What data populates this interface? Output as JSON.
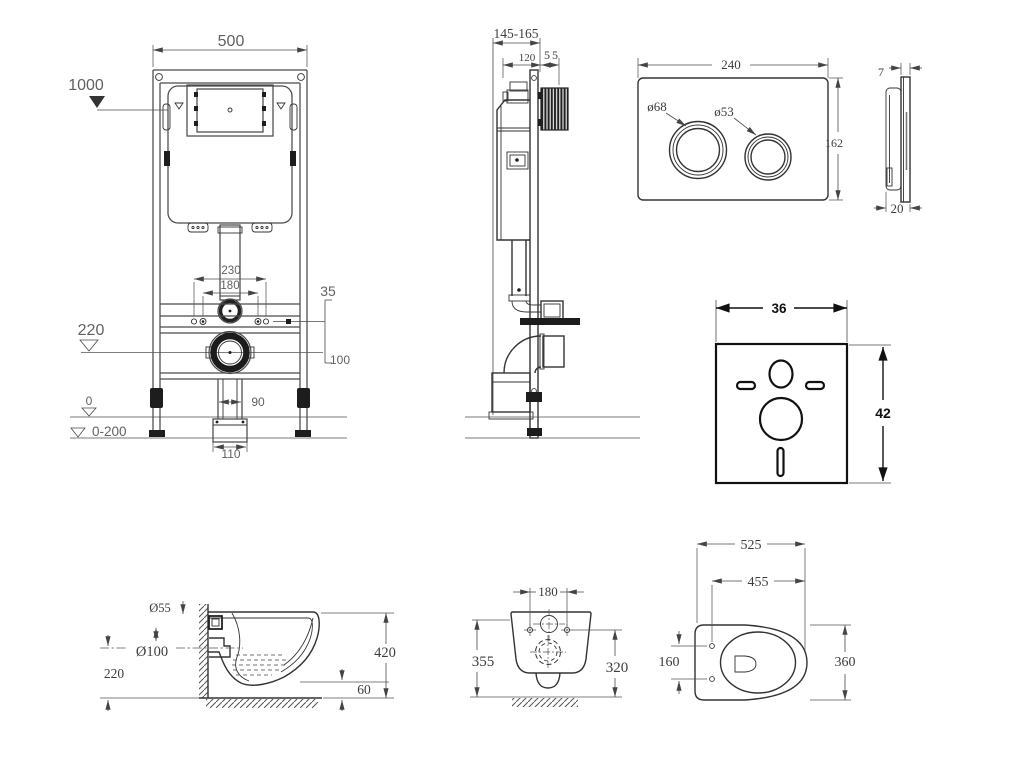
{
  "document": {
    "type": "technical installation drawing",
    "subject": "wall-hung WC frame, flush plate, sound pad and pan",
    "background_color": "#ffffff",
    "line_color": "#3d3d3d",
    "text_color": "#555555"
  },
  "views": {
    "frame_front": {
      "name": "installation frame front view",
      "dims": {
        "width": "500",
        "flush_height": "1000",
        "span_outer": "230",
        "span_inner": "180",
        "offset_a": "35",
        "offset_b": "100",
        "drain_height": "220",
        "foot_width": "90",
        "plate_width": "110",
        "level_zero": "0",
        "level_range": "0-200"
      }
    },
    "frame_side": {
      "name": "installation frame side view",
      "dims": {
        "depth_range": "145-165",
        "depth_frame": "120",
        "depth_plate": "55"
      }
    },
    "plate_front": {
      "name": "flush plate front view",
      "dims": {
        "width": "240",
        "height": "162",
        "big_button": "ø68",
        "small_button": "ø53"
      }
    },
    "plate_side": {
      "name": "flush plate side view",
      "dims": {
        "thickness": "7",
        "depth": "20"
      }
    },
    "sound_pad": {
      "name": "sound insulation pad",
      "dims": {
        "width": "36",
        "height": "42"
      }
    },
    "pan_side": {
      "name": "toilet pan side view",
      "dims": {
        "inlet": "Ø55",
        "outlet": "Ø100",
        "outlet_height": "220",
        "height": "420",
        "gap": "60"
      }
    },
    "pan_back": {
      "name": "toilet pan rear view",
      "dims": {
        "span": "180",
        "back_height": "355",
        "fixing_height": "320"
      }
    },
    "pan_top": {
      "name": "toilet pan top view",
      "dims": {
        "length": "525",
        "fixing_depth": "455",
        "fixing_span": "160",
        "width": "360"
      }
    }
  }
}
